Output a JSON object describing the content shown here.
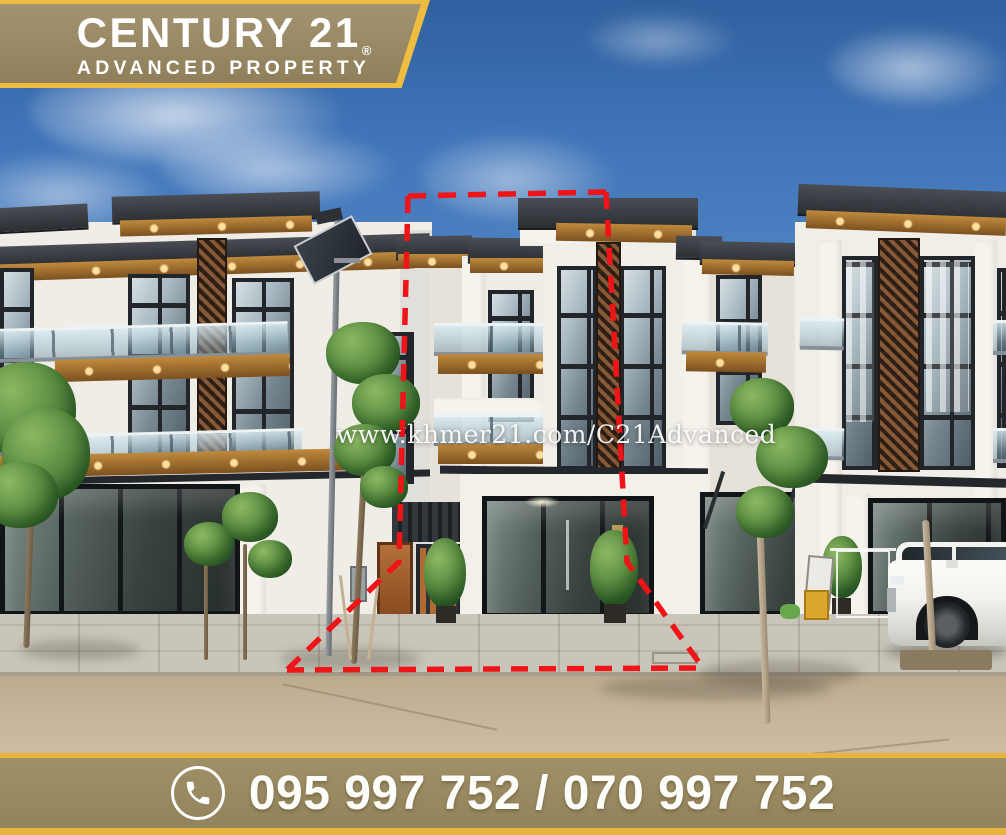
{
  "stage": {
    "width": 1006,
    "height": 835
  },
  "logo_banner": {
    "brand": "CENTURY 21",
    "registered_mark": "®",
    "subtitle": "ADVANCED PROPERTY",
    "background": "#9c8c65",
    "border": "#eebd40",
    "text_color": "#ffffff"
  },
  "watermark": {
    "text": "www.khmer21.com/C21Advanced",
    "color": "#ffffff"
  },
  "contact_banner": {
    "icon": "phone-icon",
    "phone_numbers": "095 997 752 / 070 997 752",
    "background": "#9a8a62",
    "border": "#e9b43c",
    "text_color": "#ffffff"
  },
  "property_highlight": {
    "outline_color": "#ee1418",
    "outline_style": "dashed"
  }
}
